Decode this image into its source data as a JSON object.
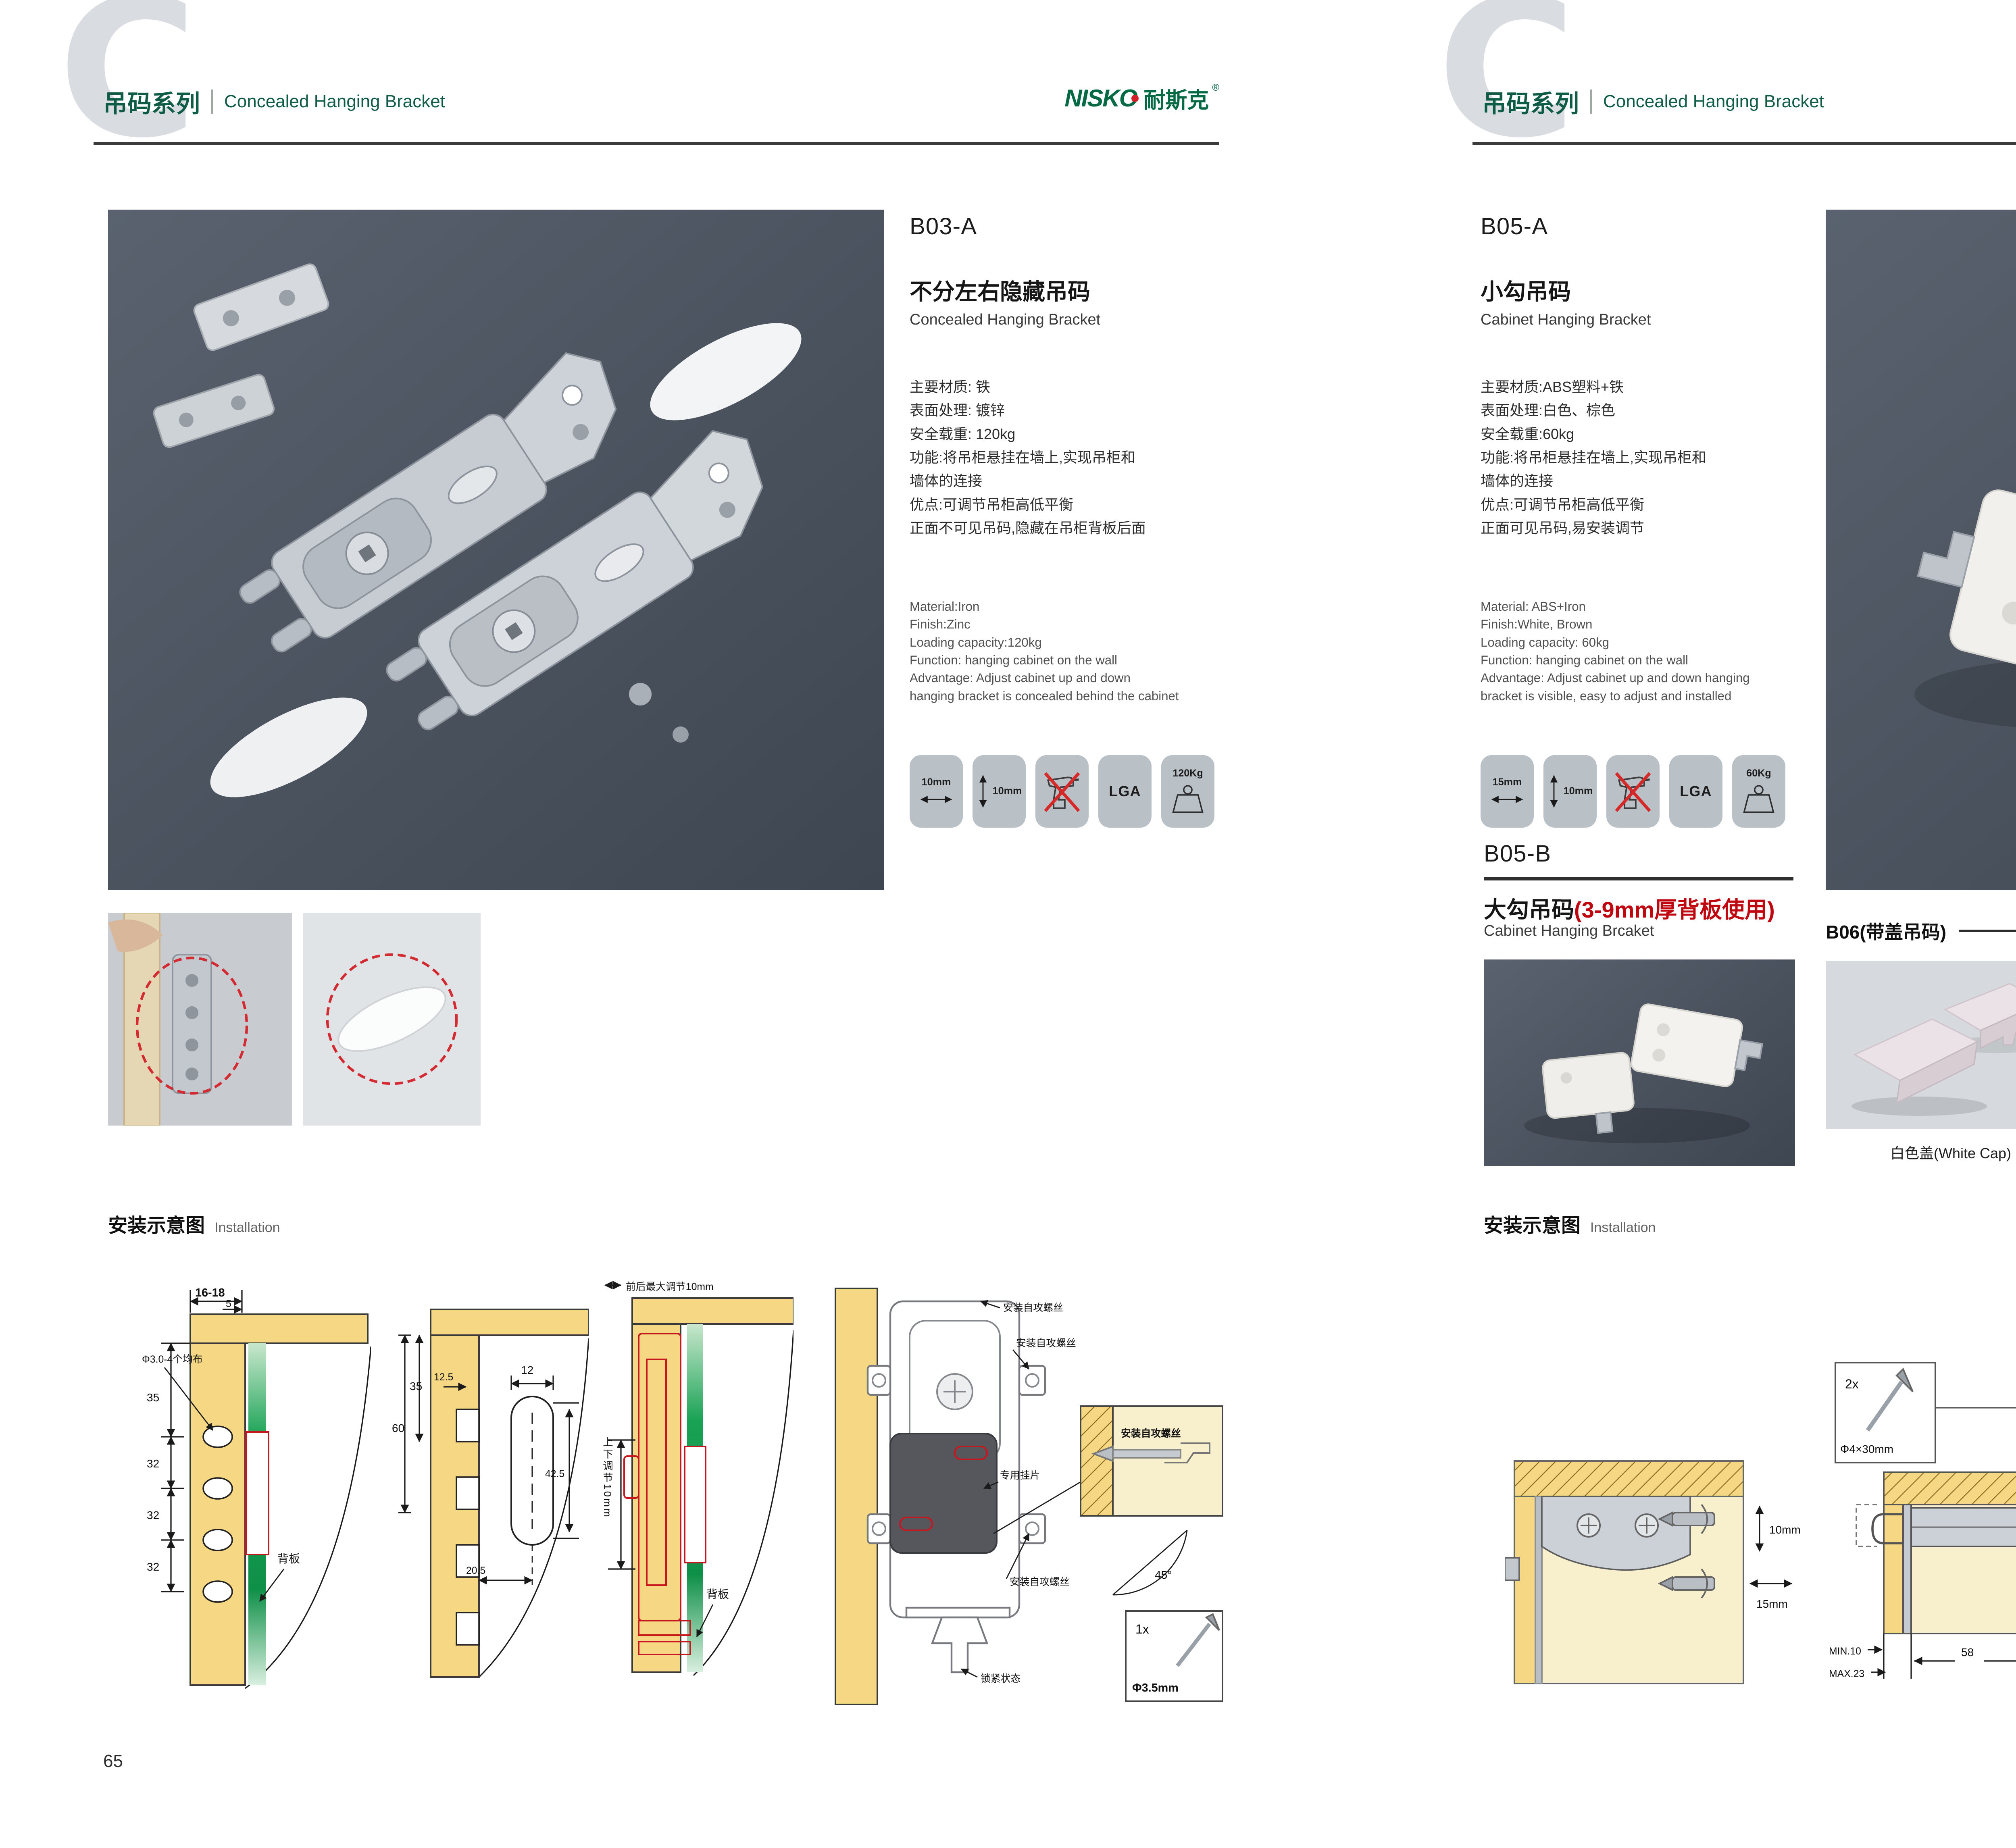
{
  "page": {
    "left_number": "65",
    "right_number": "66"
  },
  "header": {
    "watermark": "C",
    "series_cn": "吊码系列",
    "series_en": "Concealed Hanging Bracket",
    "brand_en": "NISKO",
    "brand_cn": "耐斯克",
    "brand_reg": "®"
  },
  "colors": {
    "brand_green": "#0e5c45",
    "accent_red": "#c8161e",
    "photo_slate": "#4a525e",
    "badge_gray": "#b9c0c6",
    "wood_tan": "#f5d784",
    "cap_panel_bg": "#d6dade"
  },
  "b03a": {
    "code": "B03-A",
    "name_cn": "不分左右隐藏吊码",
    "name_en": "Concealed Hanging Bracket",
    "specs_cn": [
      "主要材质: 铁",
      "表面处理: 镀锌",
      "安全载重: 120kg",
      "功能:将吊柜悬挂在墙上,实现吊柜和",
      "墙体的连接",
      "优点:可调节吊柜高低平衡",
      "正面不可见吊码,隐藏在吊柜背板后面"
    ],
    "specs_en": [
      "Material:Iron",
      "Finish:Zinc",
      "Loading capacity:120kg",
      "Function: hanging cabinet on the wall",
      "Advantage: Adjust cabinet up and down",
      "hanging bracket is concealed behind the cabinet"
    ],
    "badges": [
      {
        "icon": "arrow-horizontal",
        "label": "10mm"
      },
      {
        "icon": "arrow-vertical",
        "label": "10mm"
      },
      {
        "icon": "no-drill",
        "label": ""
      },
      {
        "icon": "lga-text",
        "label": "LGA"
      },
      {
        "icon": "weight",
        "label": "120Kg"
      }
    ]
  },
  "b05a": {
    "code": "B05-A",
    "name_cn": "小勾吊码",
    "name_en": "Cabinet Hanging Bracket",
    "specs_cn": [
      "主要材质:ABS塑料+铁",
      "表面处理:白色、棕色",
      "安全载重:60kg",
      "功能:将吊柜悬挂在墙上,实现吊柜和",
      "墙体的连接",
      "优点:可调节吊柜高低平衡",
      "正面可见吊码,易安装调节"
    ],
    "specs_en": [
      "Material: ABS+Iron",
      "Finish:White, Brown",
      "Loading capacity: 60kg",
      "Function: hanging cabinet on the wall",
      "Advantage: Adjust cabinet up and down hanging",
      "bracket is visible, easy to adjust and installed"
    ],
    "badges": [
      {
        "icon": "arrow-horizontal",
        "label": "15mm"
      },
      {
        "icon": "arrow-vertical",
        "label": "10mm"
      },
      {
        "icon": "no-drill",
        "label": ""
      },
      {
        "icon": "lga-text",
        "label": "LGA"
      },
      {
        "icon": "weight",
        "label": "60Kg"
      }
    ]
  },
  "b05b": {
    "code": "B05-B",
    "name_cn": "大勾吊码",
    "name_note": "(3-9mm厚背板使用)",
    "name_en": "Cabinet Hanging Brcaket"
  },
  "b06": {
    "title": "B06(带盖吊码)",
    "caps": [
      {
        "label": "白色盖(White Cap)",
        "color": "#eae2e6"
      },
      {
        "label": "灰色盖(Gray Cap)",
        "color": "#3a3e44"
      },
      {
        "label": "银色盖(Silver Cap)",
        "color": "#e2dadf"
      }
    ]
  },
  "installation": {
    "title_cn": "安装示意图",
    "title_en": "Installation"
  },
  "diagrams_left": {
    "d1": {
      "dim_width": "16-18",
      "dim_inset": "5",
      "dim_v1": "35",
      "dim_v2": "32",
      "dim_v3": "32",
      "dim_v4": "32",
      "hole_note": "Φ3.0-4个均布",
      "back_panel": "背板"
    },
    "d2": {
      "dim_60": "60",
      "dim_35": "35",
      "dim_125": "12.5",
      "dim_12": "12",
      "dim_425": "42.5",
      "dim_205": "20.5"
    },
    "d3": {
      "top_note": "前后最大调节10mm",
      "side_note": "上下调节10mm",
      "back_panel": "背板"
    },
    "d4": {
      "screw_note1": "安装自攻螺丝",
      "screw_note2": "安装自攻螺丝",
      "screw_note3": "安装自攻螺丝",
      "plate_note": "专用挂片",
      "lock_note": "锁紧状态",
      "detail_note": "安装自攻螺丝",
      "angle": "45°",
      "qty": "1x",
      "screw_size": "Φ3.5mm"
    }
  },
  "diagrams_right": {
    "r1": {
      "dim_v": "10mm",
      "dim_h": "15mm"
    },
    "r2": {
      "qty": "2x",
      "screw_size": "Φ4×30mm",
      "dim_18": "18",
      "dim_min": "MIN.10",
      "dim_max": "MAX.23",
      "dim_58": "58"
    },
    "r3": {
      "dim_16a": "16",
      "dim_42": "42",
      "dim_rmax": "RMAX4",
      "dim_16b": "16",
      "dim_17": "17",
      "dim_32": "32"
    }
  }
}
